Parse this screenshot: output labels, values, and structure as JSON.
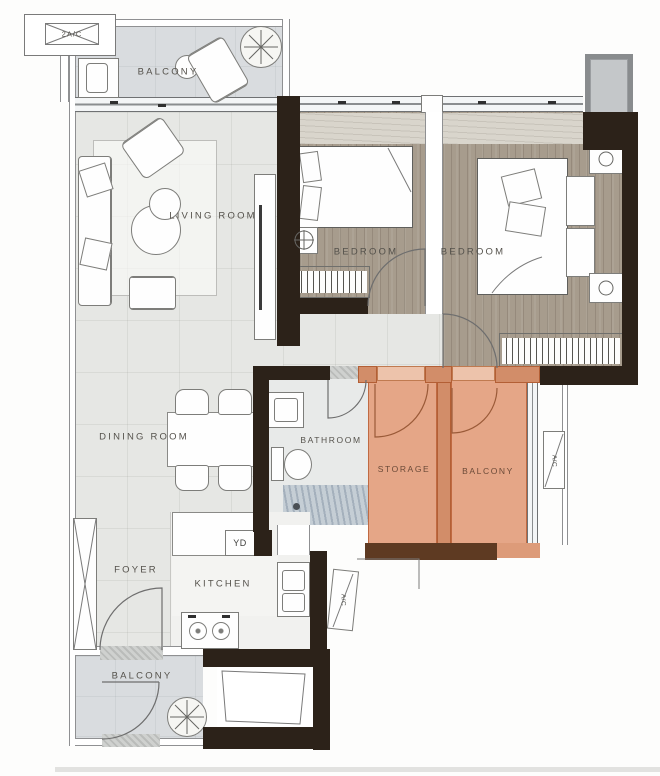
{
  "labels": {
    "ledge_ac": "2A/C",
    "balcony_top": "BALCONY",
    "living_room": "LIVING ROOM",
    "bedroom_a": "BEDROOM",
    "bedroom_b": "BEDROOM",
    "dining_room": "DINING ROOM",
    "bathroom": "BATHROOM",
    "storage": "STORAGE",
    "balcony_right": "BALCONY",
    "foyer": "FOYER",
    "kitchen": "KITCHEN",
    "balcony_bottom": "BALCONY",
    "yd_unit": "YD",
    "ac_unit_right": "A/C",
    "ac_unit_kitchen": "A/C"
  },
  "colors": {
    "wall_dark": "#2c2219",
    "wall_brown": "#5e3a22",
    "floor_main": "#e6e7e4",
    "floor_balcony": "#d9dcdf",
    "floor_wood": "#a79c8d",
    "floor_kitchen": "#f1f1ef",
    "highlight": "#e5a687",
    "highlight_border": "#c06a42",
    "label": "#55524c"
  }
}
